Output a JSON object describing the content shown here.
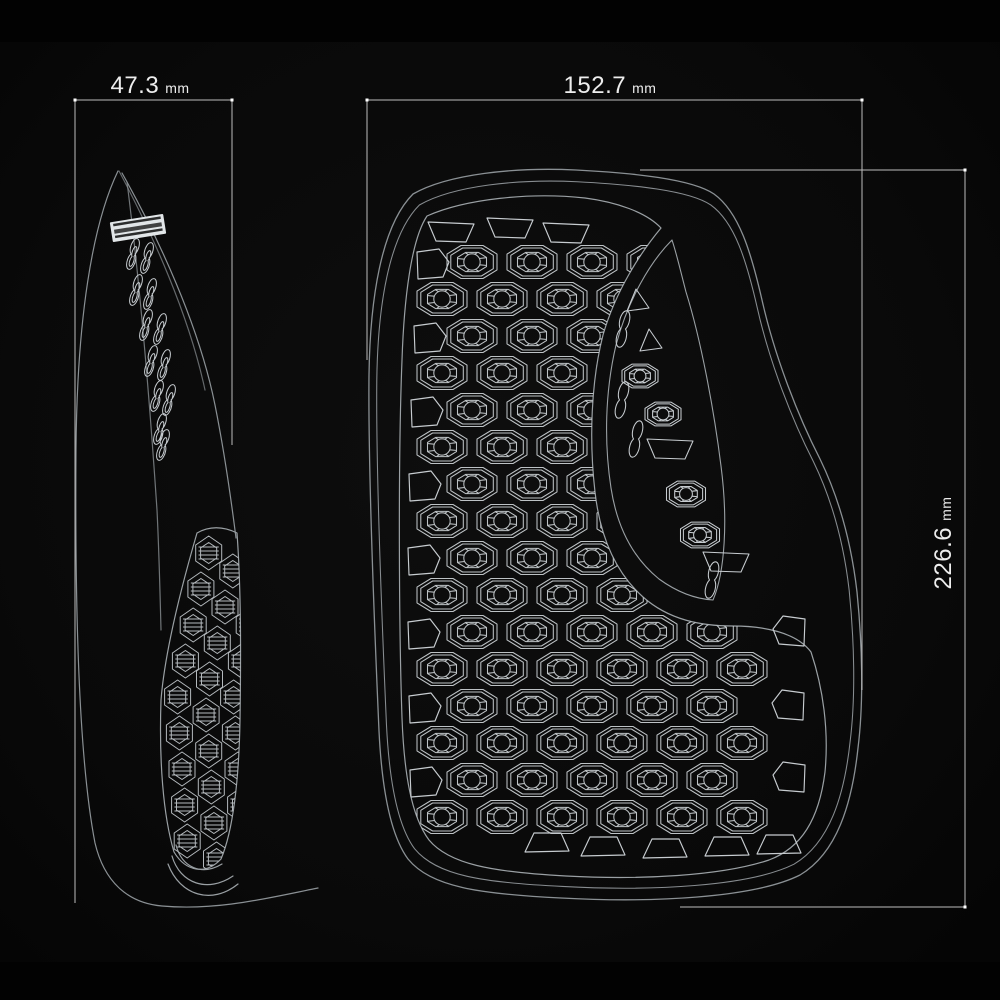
{
  "page": {
    "description": "Technical wireframe drawing of a protective pad, side profile and front view with dimensions",
    "background": "#0b0b0b"
  },
  "colors": {
    "background": "#0b0b0b",
    "letterbox_band": "#020202",
    "silhouette_line": "#8a9094",
    "contour_line": "#9aa0a4",
    "cell_line": "#c7ccd0",
    "dimension_line": "#bdbdbd",
    "tick": "#ffffff",
    "label_text": "#ededed",
    "stamp": "#e2e6e8"
  },
  "dimensions": {
    "side_width": {
      "value": "47.3",
      "unit": "mm"
    },
    "front_width": {
      "value": "152.7",
      "unit": "mm"
    },
    "front_height": {
      "value": "226.6",
      "unit": "mm"
    }
  },
  "views": {
    "side": {
      "name": "side-profile-view",
      "brand_stamp": {
        "present": true,
        "legible": false
      },
      "vent_holes": [
        [
          133,
          262
        ],
        [
          147,
          266
        ],
        [
          136,
          298
        ],
        [
          150,
          302
        ],
        [
          146,
          333
        ],
        [
          160,
          337
        ],
        [
          151,
          369
        ],
        [
          164,
          373
        ],
        [
          157,
          404
        ],
        [
          169,
          408
        ],
        [
          160,
          437
        ],
        [
          163,
          453
        ]
      ],
      "band_grid": {
        "rows": 9,
        "cols": 3,
        "y0": 553,
        "pitch_y": 36,
        "pitch_x": 28,
        "hex_w": 26,
        "hex_h": 34
      }
    },
    "front": {
      "name": "front-view",
      "grid": {
        "x0": 412,
        "y0": 262,
        "rows": 16,
        "pitch_x": 60,
        "pitch_y": 37,
        "stagger": 30,
        "cell_w": 50,
        "cell_h": 33,
        "x_min_even": 472,
        "x_max_even": 712,
        "x_min_odd": 442,
        "x_max_odd": 742
      },
      "edge_cells": {
        "top": [
          [
            451,
            232
          ],
          [
            510,
            228
          ],
          [
            566,
            233
          ]
        ],
        "left": [
          [
            432,
            265
          ],
          [
            429,
            339
          ],
          [
            426,
            413
          ],
          [
            424,
            487
          ],
          [
            423,
            561
          ],
          [
            423,
            635
          ],
          [
            424,
            709
          ],
          [
            425,
            783
          ]
        ],
        "right": [
          [
            790,
            632
          ],
          [
            789,
            706
          ],
          [
            790,
            778
          ]
        ],
        "bottom": [
          [
            547,
            843
          ],
          [
            603,
            847
          ],
          [
            665,
            849
          ],
          [
            727,
            847
          ],
          [
            779,
            845
          ]
        ]
      },
      "strip_cells": [
        {
          "t": "tri",
          "x": 637,
          "y": 301
        },
        {
          "t": "pill",
          "x": 623,
          "y": 339
        },
        {
          "t": "tri",
          "x": 650,
          "y": 341
        },
        {
          "t": "cell",
          "x": 640,
          "y": 376,
          "s": 0.72
        },
        {
          "t": "pill",
          "x": 622,
          "y": 410
        },
        {
          "t": "cell",
          "x": 663,
          "y": 414,
          "s": 0.72
        },
        {
          "t": "pill",
          "x": 636,
          "y": 449
        },
        {
          "t": "trap",
          "x": 670,
          "y": 449
        },
        {
          "t": "cell",
          "x": 686,
          "y": 494,
          "s": 0.78
        },
        {
          "t": "cell",
          "x": 700,
          "y": 535,
          "s": 0.78
        },
        {
          "t": "trap",
          "x": 726,
          "y": 562
        },
        {
          "t": "pill",
          "x": 712,
          "y": 590
        }
      ]
    }
  }
}
